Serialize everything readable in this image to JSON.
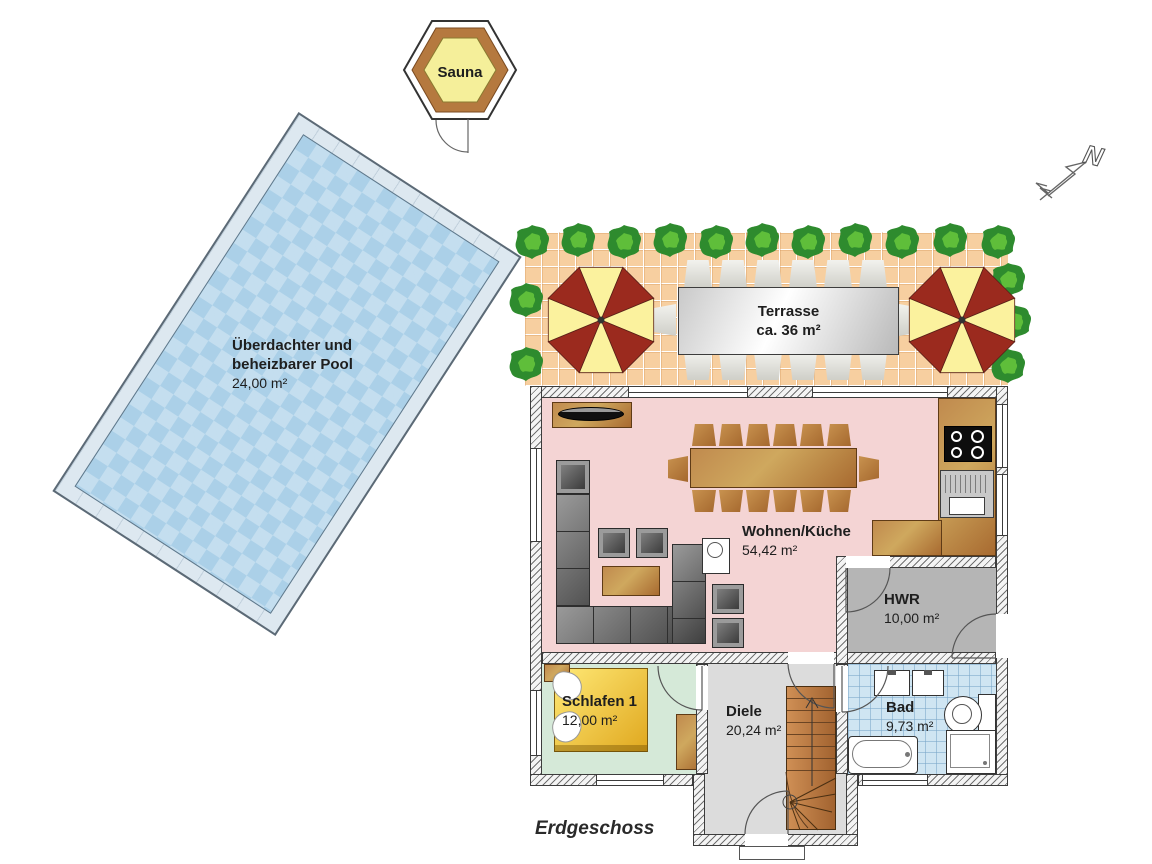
{
  "floor": {
    "label": "Erdgeschoss"
  },
  "compass": {
    "north_label": "N"
  },
  "outdoor": {
    "sauna": {
      "name": "Sauna"
    },
    "pool": {
      "name_line1": "Überdachter und",
      "name_line2": "beheizbarer Pool",
      "area": "24,00 m²"
    },
    "terrace": {
      "name": "Terrasse",
      "area": "ca. 36 m²"
    }
  },
  "rooms": {
    "wohnen": {
      "name": "Wohnen/Küche",
      "area": "54,42 m²"
    },
    "hwr": {
      "name": "HWR",
      "area": "10,00 m²"
    },
    "schlafen": {
      "name": "Schlafen 1",
      "area": "12,00 m²"
    },
    "diele": {
      "name": "Diele",
      "area": "20,24 m²"
    },
    "bad": {
      "name": "Bad",
      "area": "9,73 m²"
    }
  },
  "colors": {
    "pool_water": "#abd0e8",
    "pool_deck": "#dde8f0",
    "terrace_tile": "#f7cfa0",
    "living": "#f4d4d4",
    "bedroom": "#d5e9d8",
    "hall": "#dcdcdc",
    "bath": "#cfe5f2",
    "utility": "#b5b5b5",
    "wood": "#b5793f",
    "bed_yellow": "#f2c63e",
    "sofa_gray": "#6b6b6b",
    "parasol_red": "#9b2a1e",
    "parasol_yellow": "#fbf29e",
    "bush_green": "#2e8b2e",
    "sauna_yellow": "#f5ef9a",
    "sauna_brown": "#b5793f",
    "wall_outline": "#3c3c3c"
  }
}
